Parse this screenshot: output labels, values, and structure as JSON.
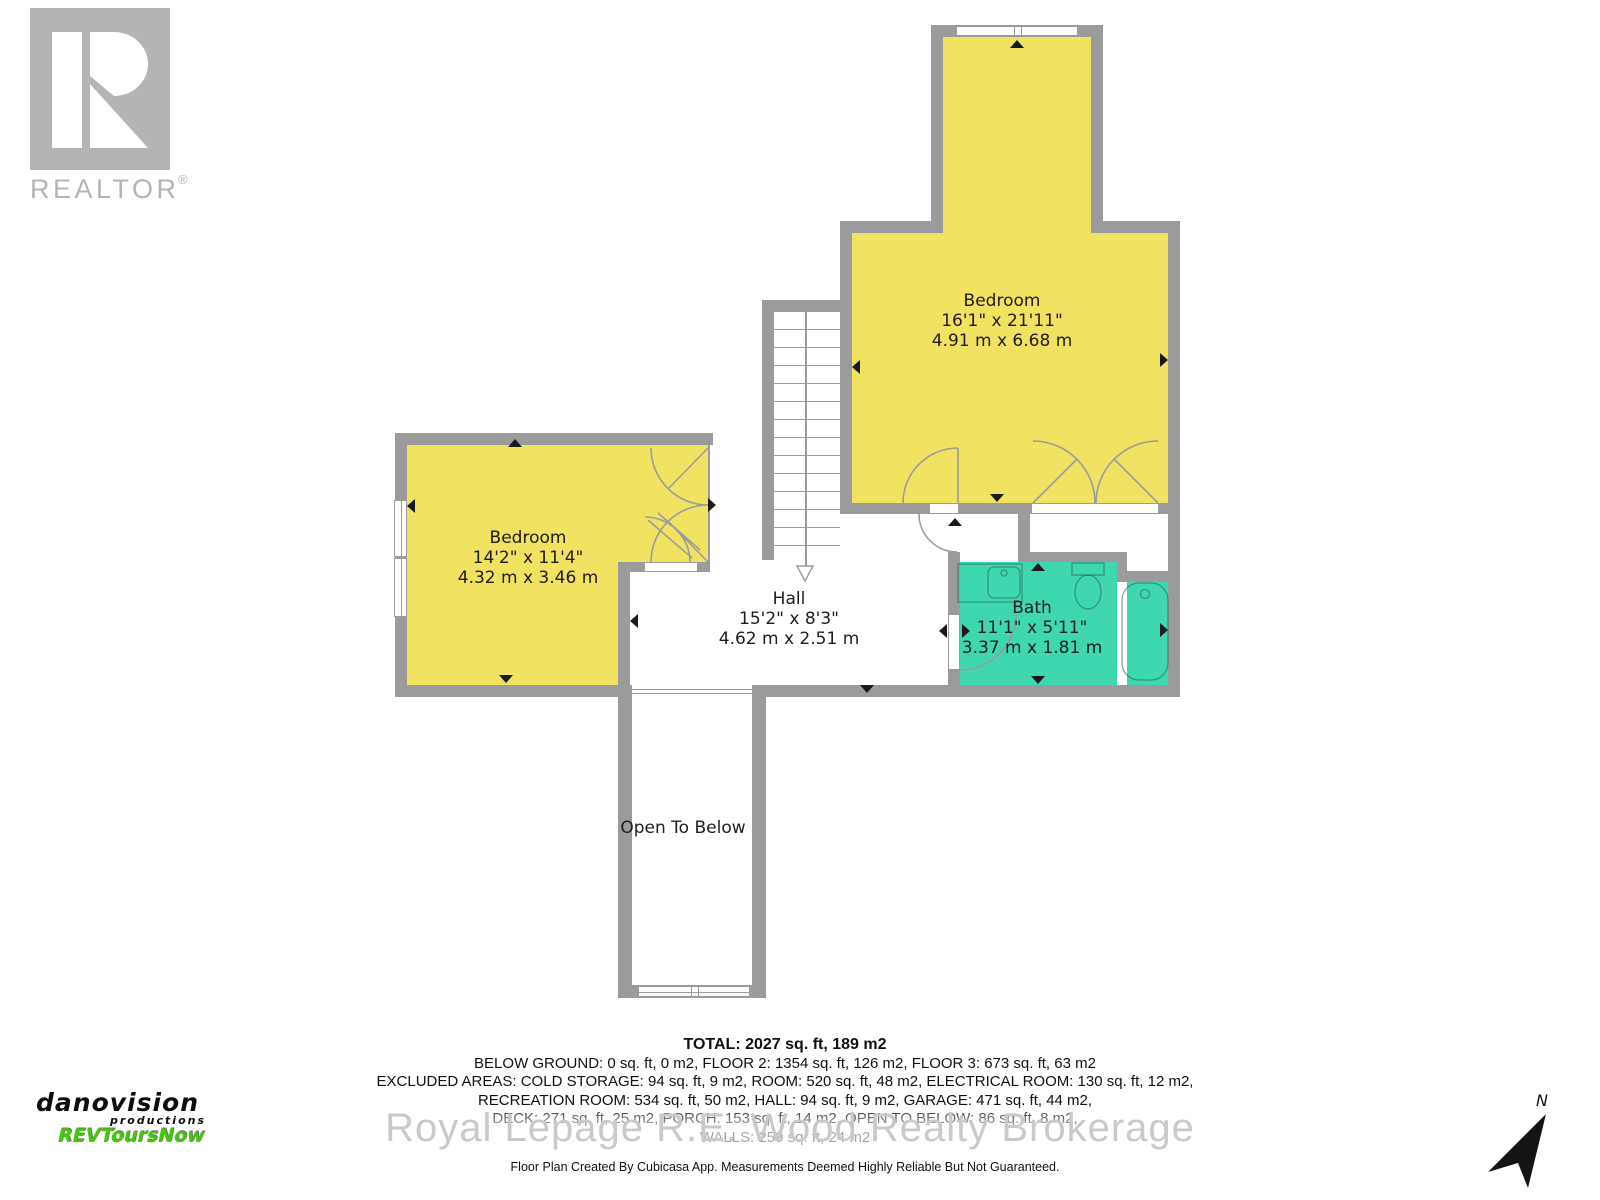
{
  "branding": {
    "realtor": {
      "logo_text": "REALTOR",
      "reg": "®"
    },
    "producer": {
      "line1": "danovision",
      "line2": "productions",
      "line3": "REVToursNow",
      "accent_color": "#3FCC00"
    },
    "watermark": "Royal Lepage R.E. Wood Realty Brokerage",
    "compass": {
      "label": "N"
    }
  },
  "plan": {
    "colors": {
      "wall": "#9B9B9B",
      "room_yellow": "#F1E262",
      "room_teal": "#3FD7B0",
      "floor": "#FFFFFF",
      "tick": "#1A1A1A"
    },
    "rooms": [
      {
        "name": "Bedroom",
        "imperial": "16'1\" x 21'11\"",
        "metric": "4.91 m x 6.68 m"
      },
      {
        "name": "Bedroom",
        "imperial": "14'2\" x 11'4\"",
        "metric": "4.32 m x 3.46 m"
      },
      {
        "name": "Hall",
        "imperial": "15'2\" x 8'3\"",
        "metric": "4.62 m x 2.51 m"
      },
      {
        "name": "Bath",
        "imperial": "11'1\" x 5'11\"",
        "metric": "3.37 m x 1.81 m"
      },
      {
        "name": "Open To Below"
      }
    ]
  },
  "summary": {
    "total": "TOTAL: 2027 sq. ft, 189 m2",
    "line2": "BELOW GROUND: 0 sq. ft, 0 m2, FLOOR 2: 1354 sq. ft, 126 m2, FLOOR 3: 673 sq. ft, 63 m2",
    "line3": "EXCLUDED AREAS: COLD STORAGE: 94 sq. ft, 9 m2, ROOM: 520 sq. ft, 48 m2, ELECTRICAL ROOM: 130 sq. ft, 12 m2,",
    "line4": "RECREATION ROOM: 534 sq. ft, 50 m2, HALL: 94 sq. ft, 9 m2, GARAGE: 471 sq. ft, 44 m2,",
    "line5": "DECK: 271 sq. ft, 25 m2, PORCH: 153 sq. ft, 14 m2, OPEN TO BELOW: 86 sq. ft, 8 m2,",
    "line6": "WALLS: 259 sq. ft, 24 m2"
  },
  "disclaimer": "Floor Plan Created By Cubicasa App. Measurements Deemed Highly Reliable But Not Guaranteed."
}
